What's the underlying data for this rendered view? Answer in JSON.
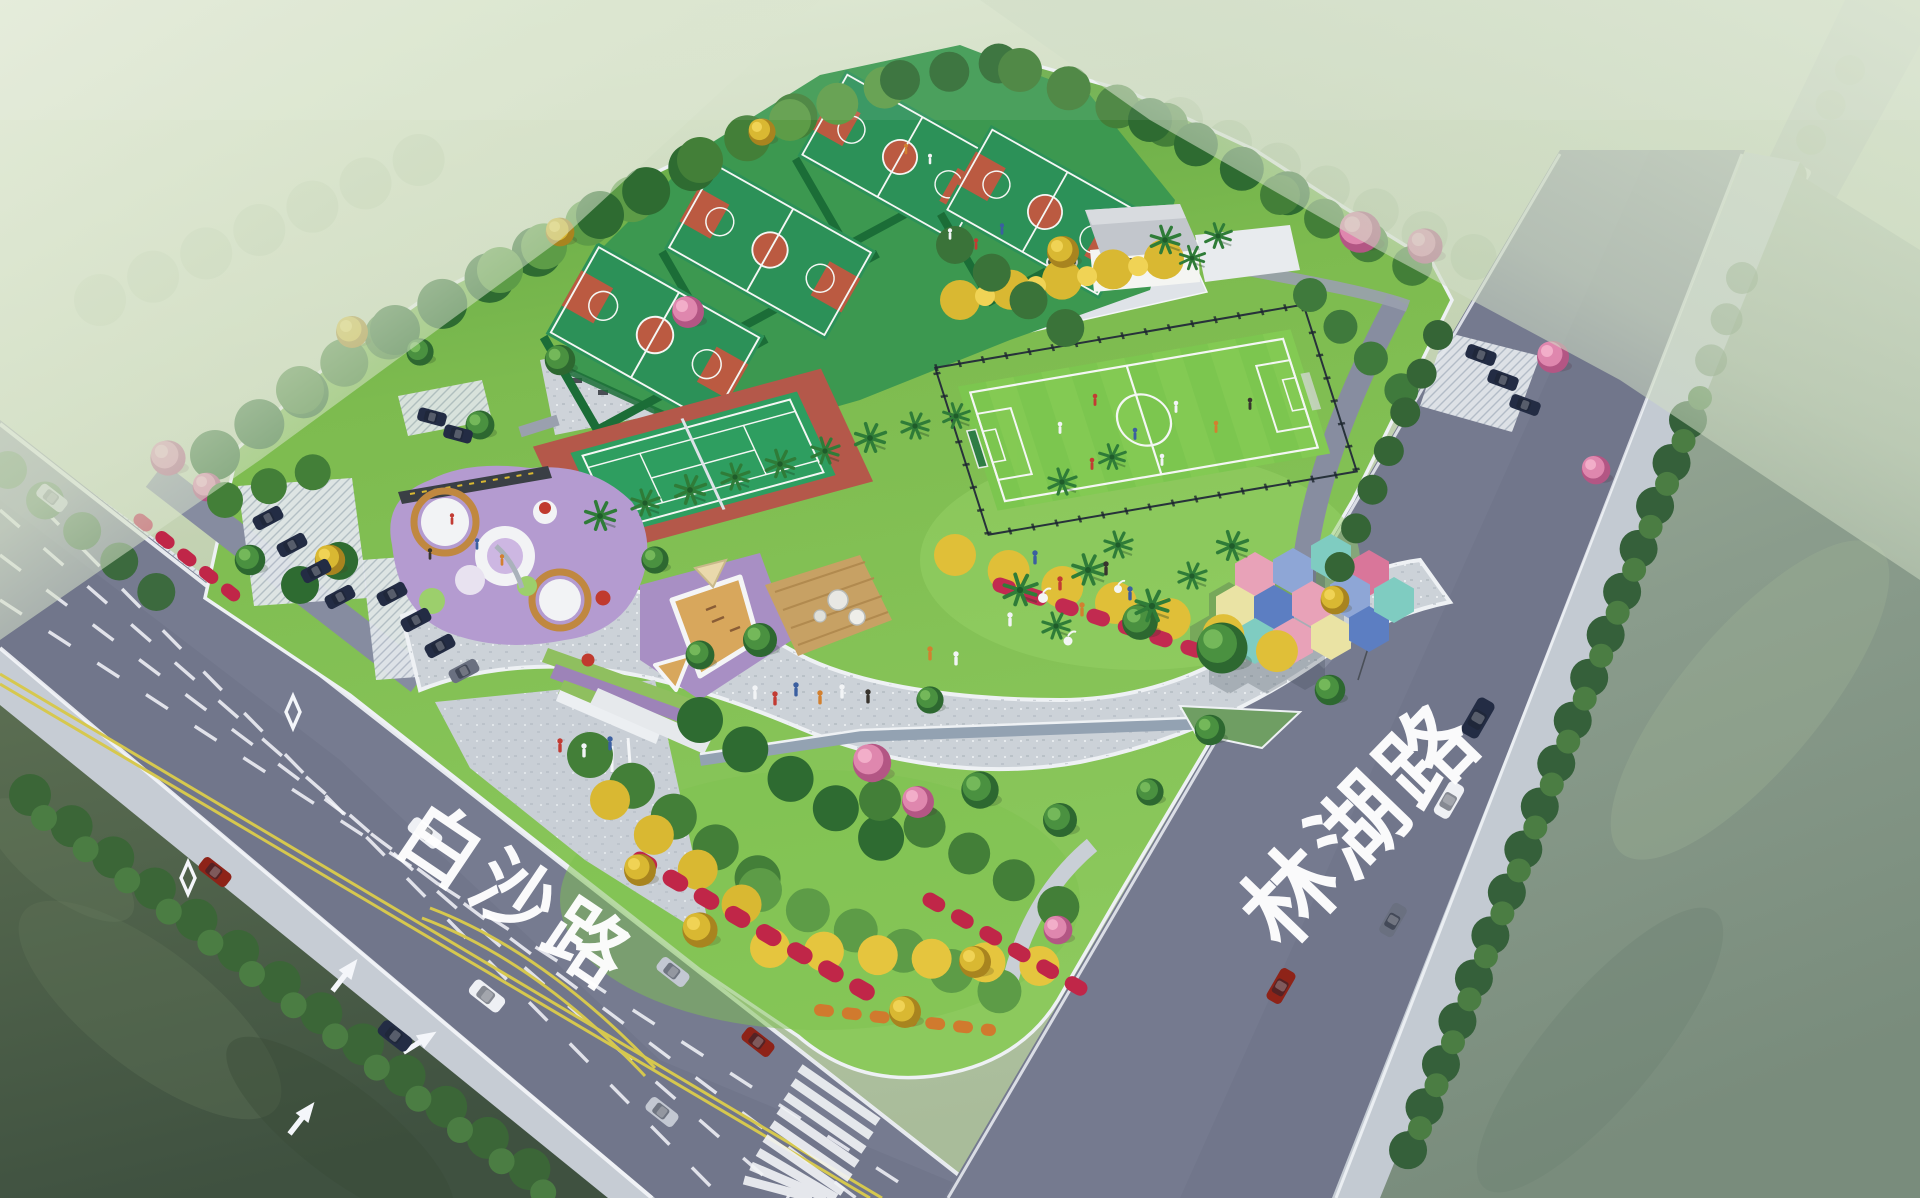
{
  "meta": {
    "scene": "aerial landscape-architecture rendering of a community sports park at a road junction",
    "view": "bird's-eye perspective, site bounded by two roads and water channels"
  },
  "roads": {
    "baisha": {
      "label": "白沙路",
      "position": "lower-left",
      "lanes": "multi-lane with double yellow centerline, dashed white lanes, lane arrows, diamond markings"
    },
    "linhu": {
      "label": "林湖路",
      "position": "right",
      "lanes": "plain asphalt with street-tree verge"
    }
  },
  "features": {
    "basketball_courts": {
      "count": 4,
      "surface": "green with red keys and center circles",
      "setting": "terraced platform among trees"
    },
    "tennis_court": {
      "count": 1,
      "surface": "green court on red apron, white doubles lines, net"
    },
    "football_field": {
      "count": 1,
      "details": "fenced grass pitch, white markings, players"
    },
    "playground": {
      "surface": "purple rubber with white/tan circle pads, red play domes, slide"
    },
    "sand_play_area": {
      "surface": "tan sand pads with white borders on purple apron, beige shade canopy"
    },
    "hexagon_canopies": {
      "count": 13,
      "description": "colorful honeycomb shade pavilion on plaza"
    },
    "central_lawn": {
      "details": "palm trees, white egret sculptures, visitors"
    },
    "service_building": {
      "count": 1,
      "details": "flat grey roof, white walls, palms, small pond"
    },
    "promenade": {
      "details": "wide light granite esplanade winding through the park"
    },
    "stream": {
      "details": "narrow water rill with green pond wedge along promenade"
    },
    "entrance_plaza": {
      "details": "paved apron off Baisha Rd with terraced planting, white walls and masts"
    },
    "crosswalk": {
      "details": "zebra crossing at the road junction"
    },
    "parking": {
      "west_cars": 10,
      "northeast_cars": 3,
      "surface": "white grass-paver stalls"
    }
  },
  "vehicles": {
    "baisha_road_cars": 8,
    "linhu_road_cars": 4,
    "colors": [
      "navy",
      "white",
      "silver",
      "dark red",
      "grey"
    ]
  },
  "vegetation": {
    "street_trees": "dense dark green rows along both roads",
    "accent_trees": [
      "yellow flowering (golden trumpet)",
      "pink flowering",
      "palms"
    ],
    "flower_beds": "magenta/red and orange drifts on the south mound"
  },
  "water": {
    "southwest": "dark olive-green channel",
    "southeast": "grey-green channel"
  },
  "colors": {
    "haze1": "#dde7d2",
    "haze2": "#b9c9ab",
    "waterL1": "#5b6e52",
    "waterL2": "#3f5140",
    "waterR1": "#a3b49c",
    "waterR2": "#798c7c",
    "road": "#71768b",
    "road2": "#7d8297",
    "lane": "#f4f6fa",
    "yellow": "#d6c84e",
    "paver": "#cdd3d9",
    "paverlt": "#e2e6eb",
    "kerb": "#f0f2f5",
    "lawn1": "#8cc95d",
    "lawn2": "#5ea344",
    "pitch": "#7cc64f",
    "pitch2": "#8ace58",
    "court": "#2c9158",
    "courtred": "#bb5a41",
    "tencourt": "#2e9e60",
    "tenred": "#b4584a",
    "platform": "#3c9850",
    "terrace": "#1b6d37",
    "pgpurple": "#b49bd0",
    "pgring": "#c08840",
    "pggreen": "#9ccf6c",
    "sand": "#d8a75c",
    "deck": "#c7a164",
    "treedark": "#2d6830",
    "treemid": "#4a9140",
    "treelite": "#74b85a",
    "yel2": "#d9b832",
    "yel3": "#f0d355",
    "pink2": "#df87ae",
    "palm": "#2f7c38",
    "flower": "#c22a50",
    "stream": "#93a2b2",
    "roofc": "#c2c6cc",
    "wallc": "#f4f5f2",
    "hex1": "#7fccc1",
    "hex2": "#e8a2b8",
    "hex3": "#8ea6d6",
    "hex4": "#eae3a4",
    "hex5": "#5c7ec2",
    "hex6": "#d9769a",
    "carnavy": "#232c44",
    "carwhite": "#eef0f4",
    "carsilver": "#c3c8d2",
    "carred": "#8e2318",
    "cargrey": "#6a7080",
    "label": "#ffffff"
  }
}
